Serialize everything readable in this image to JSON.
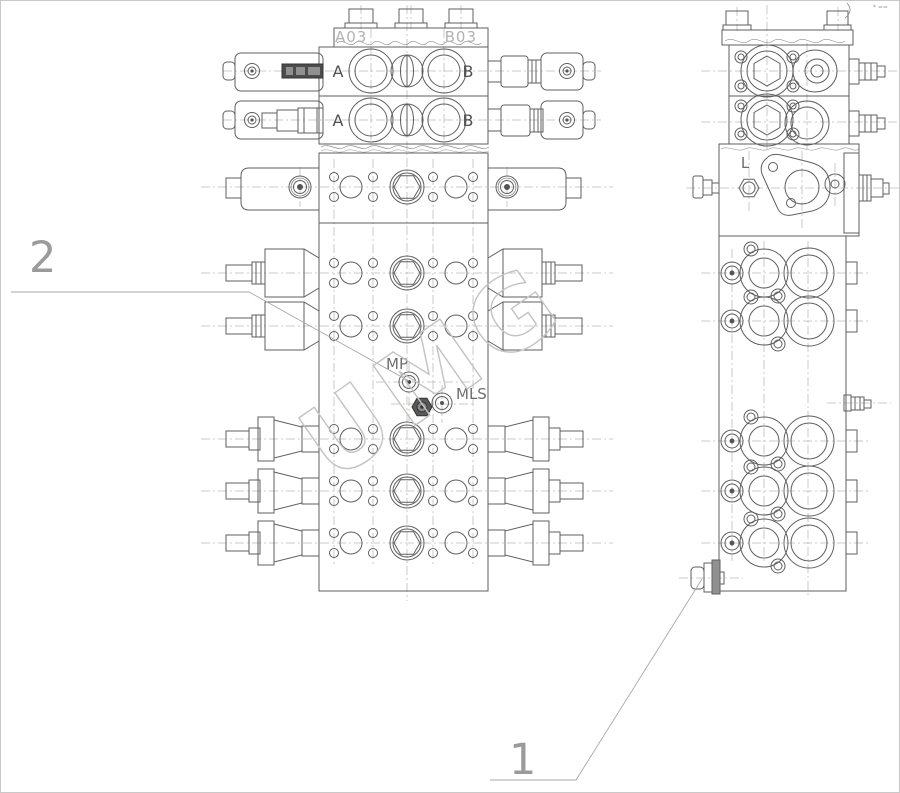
{
  "drawing": {
    "title_watermark": "UMG",
    "corner_mark": "* ==",
    "callouts": {
      "item1": "1",
      "item2": "2"
    },
    "front_view": {
      "port_a03": "A03",
      "port_b03": "B03",
      "sections": [
        {
          "a": "A",
          "b": "B"
        },
        {
          "a": "A",
          "b": "B"
        }
      ],
      "port_mp": "MP",
      "port_mls": "MLS"
    },
    "side_view": {
      "port_l": "L"
    }
  },
  "colors": {
    "line": "#5f5f5f",
    "centerline": "#b6bfb4",
    "ghost_label": "#b2b2b2",
    "callout": "#9b9b9b",
    "watermark": "#c3c3c3",
    "nameplate": "#4c4c4c"
  }
}
